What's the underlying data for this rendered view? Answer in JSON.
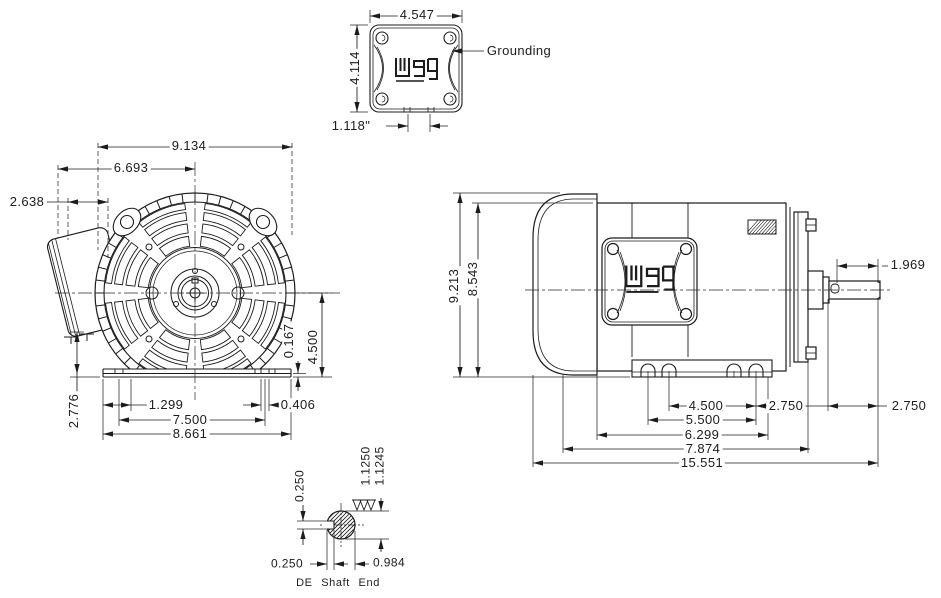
{
  "drawing": {
    "brand": "weg",
    "labels": {
      "grounding": "Grounding",
      "de_shaft_end": "DE Shaft End"
    },
    "top_view": {
      "box_width": "4.547",
      "box_height": "4.114",
      "knockout_spacing": "1.118\""
    },
    "front_view": {
      "fan_cover_diameter": "9.134",
      "box_to_center": "6.693",
      "box_width": "2.638",
      "box_bottom_to_base": "2.776",
      "foot_edge_to_hole": "1.299",
      "foot_hole_span": "7.500",
      "foot_overall_width": "8.661",
      "foot_slot_width": "0.406",
      "pad_thickness": "0.167",
      "shaft_center_height": "4.500"
    },
    "side_view": {
      "overall_height": "9.213",
      "frame_height": "8.543",
      "shaft_usable_length": "1.969",
      "foot_hole_spacing_short": "4.500",
      "foot_hole_spacing_long": "5.500",
      "foot_length": "6.299",
      "frame_length": "7.874",
      "overall_length": "15.551",
      "hole_to_mounting_face": "2.750",
      "shaft_extension": "2.750"
    },
    "shaft_detail": {
      "keyway_width": "0.250",
      "diameter_max": "1.1250",
      "diameter_min": "1.1245",
      "keyway_depth": "0.250",
      "flat_to_opposite": "0.984"
    }
  }
}
